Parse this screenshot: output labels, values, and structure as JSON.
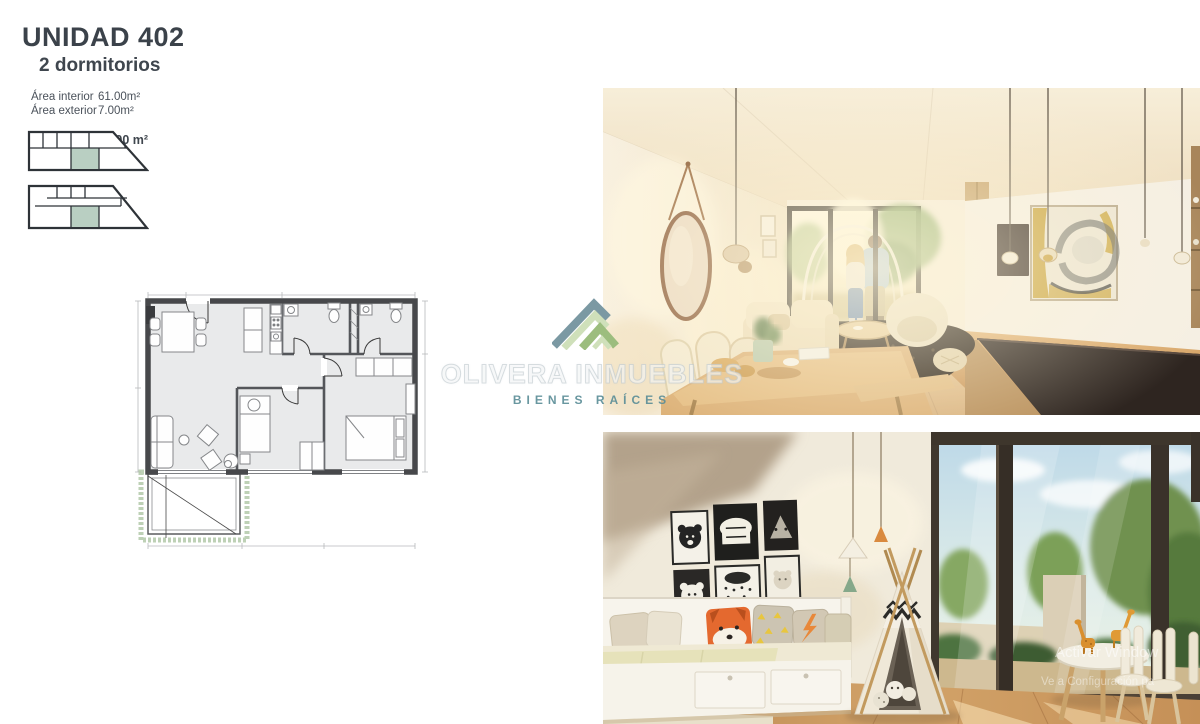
{
  "unit": {
    "title": "UNIDAD 402",
    "subtitle": "2 dormitorios",
    "areas": [
      {
        "label": "Área interior",
        "value": "61.00m²"
      },
      {
        "label": "Área exterior",
        "value": "7.00m²"
      }
    ],
    "total": {
      "label": "Total",
      "value": "68.00 m²"
    }
  },
  "brand": {
    "name": "OLIVERA INMUEBLES",
    "tagline": "BIENES RAÍCES",
    "logo_colors": {
      "slate": "#7b99a3",
      "light_green": "#cfe0ba",
      "mid_green": "#9cbd7e"
    },
    "tagline_color": "#5d8f98"
  },
  "floor_plan": {
    "unit_highlight_color": "#b9cfc2",
    "wall_color": "#47484b",
    "terrace_hedge_color": "#aec5a4"
  },
  "photos": {
    "living": {
      "name": "render-living-comedor"
    },
    "kids": {
      "name": "render-dormitorio-infantil"
    }
  },
  "activation": {
    "line1": "Activar Window",
    "line2": "Ve a Configuración pa"
  }
}
